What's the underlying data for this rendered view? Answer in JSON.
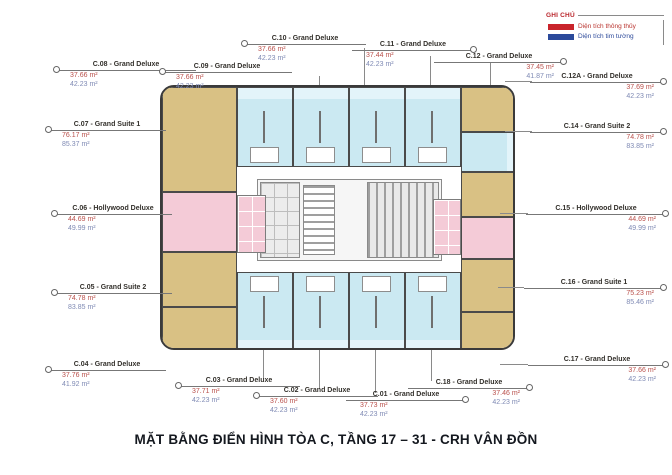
{
  "title": "MẶT BẰNG ĐIỂN HÌNH TÒA C, TẦNG 17 – 31 - CRH VÂN ĐỒN",
  "legend": {
    "title": "GHI CHÚ",
    "items": [
      {
        "label": "Diện tích thông thủy",
        "color": "#c9242b"
      },
      {
        "label": "Diện tích tim tường",
        "color": "#2b4a9b"
      }
    ]
  },
  "units": {
    "c01": {
      "name": "C.01 - Grand Deluxe",
      "area_red": "37.73 m²",
      "area_blue": "42.23 m²"
    },
    "c02": {
      "name": "C.02 - Grand Deluxe",
      "area_red": "37.60 m²",
      "area_blue": "42.23 m²"
    },
    "c03": {
      "name": "C.03 - Grand Deluxe",
      "area_red": "37.71 m²",
      "area_blue": "42.23 m²"
    },
    "c04": {
      "name": "C.04 - Grand Deluxe",
      "area_red": "37.76 m²",
      "area_blue": "41.92 m²"
    },
    "c05": {
      "name": "C.05 - Grand Suite 2",
      "area_red": "74.78 m²",
      "area_blue": "83.85 m²"
    },
    "c06": {
      "name": "C.06 - Hollywood Deluxe",
      "area_red": "44.69 m²",
      "area_blue": "49.99 m²"
    },
    "c07": {
      "name": "C.07 - Grand Suite 1",
      "area_red": "76.17 m²",
      "area_blue": "85.37 m²"
    },
    "c08": {
      "name": "C.08 - Grand Deluxe",
      "area_red": "37.66 m²",
      "area_blue": "42.23 m²"
    },
    "c09": {
      "name": "C.09 - Grand Deluxe",
      "area_red": "37.66 m²",
      "area_blue": "42.23 m²"
    },
    "c10": {
      "name": "C.10 - Grand Deluxe",
      "area_red": "37.66 m²",
      "area_blue": "42.23 m²"
    },
    "c11": {
      "name": "C.11 - Grand Deluxe",
      "area_red": "37.44 m²",
      "area_blue": "42.23 m²"
    },
    "c12": {
      "name": "C.12 - Grand Deluxe",
      "area_red": "37.45 m²",
      "area_blue": "41.87 m²"
    },
    "c12a": {
      "name": "C.12A - Grand Deluxe",
      "area_red": "37.69 m²",
      "area_blue": "42.23 m²"
    },
    "c14": {
      "name": "C.14 - Grand Suite 2",
      "area_red": "74.78 m²",
      "area_blue": "83.85 m²"
    },
    "c15": {
      "name": "C.15 - Hollywood Deluxe",
      "area_red": "44.69 m²",
      "area_blue": "49.99 m²"
    },
    "c16": {
      "name": "C.16 - Grand Suite 1",
      "area_red": "75.23 m²",
      "area_blue": "85.46 m²"
    },
    "c17": {
      "name": "C.17 - Grand Deluxe",
      "area_red": "37.66 m²",
      "area_blue": "42.23 m²"
    },
    "c18": {
      "name": "C.18 - Grand Deluxe",
      "area_red": "37.46 m²",
      "area_blue": "42.23 m²"
    }
  },
  "colors": {
    "grand_deluxe_fill": "#cbe9f2",
    "suite_fill": "#d9c184",
    "hollywood_fill": "#f4cbd7",
    "wall": "#3a3a3a",
    "area_red_text": "#b9504b",
    "area_blue_text": "#7f8ab4"
  }
}
